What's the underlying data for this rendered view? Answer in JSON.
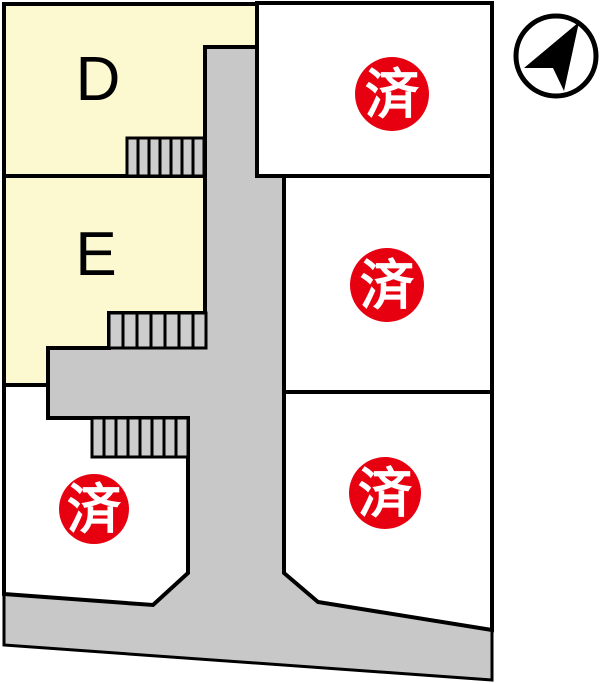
{
  "map": {
    "type": "residential-lot-map",
    "lots": {
      "d": {
        "label": "D",
        "status_badge": ""
      },
      "e": {
        "label": "E",
        "status_badge": ""
      },
      "right_top": {
        "label": "",
        "status_badge": "済"
      },
      "right_middle": {
        "label": "",
        "status_badge": "済"
      },
      "right_bottom": {
        "label": "",
        "status_badge": "済"
      },
      "left_bottom": {
        "label": "",
        "status_badge": "済"
      }
    },
    "icons": {
      "compass": "north-arrow-icon"
    },
    "colors": {
      "lot_available_fill": "#fcf9d0",
      "lot_sold_fill": "#ffffff",
      "road_fill": "#c8c8c8",
      "stairs_fill": "#cdcdcd",
      "outline": "#000000",
      "sold_badge_fill": "#e60010",
      "sold_badge_text": "#ffffff"
    }
  }
}
